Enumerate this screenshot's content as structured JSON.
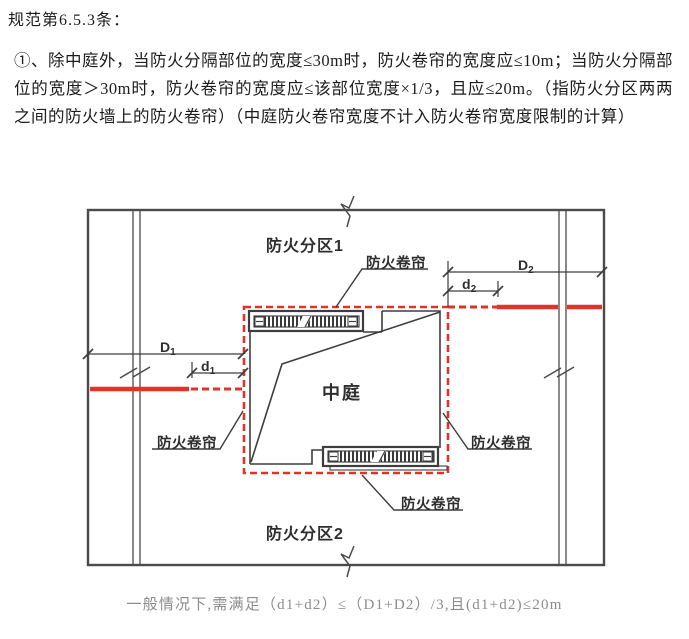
{
  "document": {
    "heading": "规范第6.5.3条：",
    "body": "①、除中庭外，当防火分隔部位的宽度≤30m时，防火卷帘的宽度应≤10m；当防火分隔部位的宽度＞30m时，防火卷帘的宽度应≤该部位宽度×1/3，且应≤20m。（指防火分区两两之间的防火墙上的防火卷帘）（中庭防火卷帘宽度不计入防火卷帘宽度限制的计算）",
    "caption": "一般情况下,需满足（d1+d2）≤（D1+D2）/3,且(d1+d2)≤20m"
  },
  "diagram": {
    "zone1_label": "防火分区1",
    "zone2_label": "防火分区2",
    "atrium_label": "中庭",
    "shutter_label_top": "防火卷帘",
    "shutter_label_left": "防火卷帘",
    "shutter_label_right": "防火卷帘",
    "shutter_label_bottom": "防火卷帘",
    "dims": {
      "D1": {
        "letter": "D",
        "sub": "1"
      },
      "d1": {
        "letter": "d",
        "sub": "1"
      },
      "D2": {
        "letter": "D",
        "sub": "2"
      },
      "d2": {
        "letter": "d",
        "sub": "2"
      }
    },
    "colors": {
      "fire_boundary_red": "#e0332a",
      "drawing_line": "#3d3d3d"
    }
  }
}
